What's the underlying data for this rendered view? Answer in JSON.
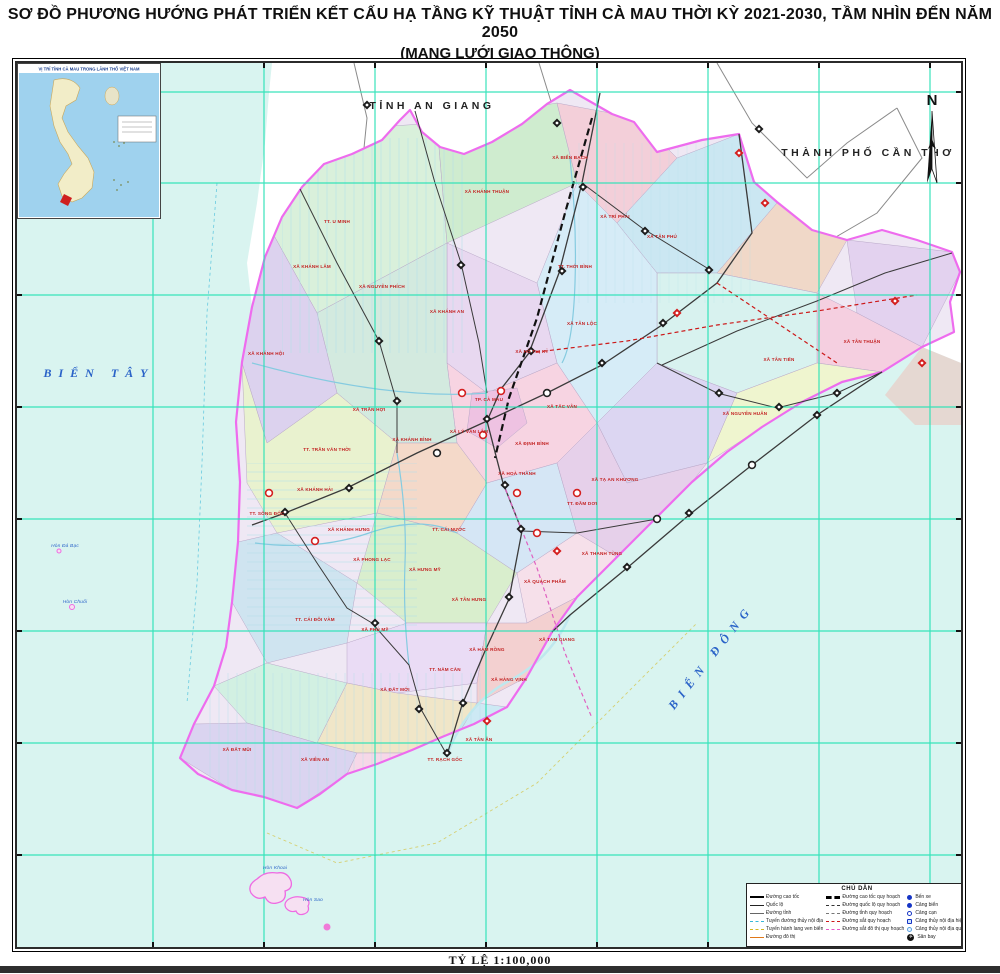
{
  "title": {
    "line1": "SƠ ĐỒ PHƯƠNG HƯỚNG PHÁT TRIỂN KẾT CẤU HẠ TẦNG KỸ THUẬT TỈNH CÀ MAU THỜI KỲ 2021-2030, TẦM NHÌN ĐẾN NĂM 2050",
    "line2": "(MẠNG LƯỚI GIAO THÔNG)"
  },
  "inset": {
    "title": "VỊ TRÍ TỈNH CÀ MAU TRONG LÃNH THỔ VIỆT NAM"
  },
  "compass": {
    "north_label": "N"
  },
  "scale": {
    "label": "TỶ LỆ 1:100,000"
  },
  "legend": {
    "title": "CHÚ DẪN",
    "columns": [
      {
        "items": [
          {
            "type": "exp",
            "label": "Đường cao tốc"
          },
          {
            "type": "nat",
            "label": "Quốc lộ"
          },
          {
            "type": "prov",
            "label": "Đường tỉnh"
          },
          {
            "type": "wat",
            "label": "Tuyến đường thủy nội địa"
          },
          {
            "type": "coast",
            "label": "Tuyến hành lang ven biển"
          },
          {
            "type": "urb",
            "label": "Đường đô thị"
          }
        ]
      },
      {
        "items": [
          {
            "type": "expp",
            "label": "Đường cao tốc quy hoạch"
          },
          {
            "type": "natp",
            "label": "Đường quốc lộ quy hoạch"
          },
          {
            "type": "provp",
            "label": "Đường tỉnh quy hoạch"
          },
          {
            "type": "rail",
            "label": "Đường sắt quy hoạch"
          },
          {
            "type": "metp",
            "label": "Đường sắt đô thị quy hoạch"
          }
        ]
      },
      {
        "items": [
          {
            "type": "port",
            "label": "Bến xe"
          },
          {
            "type": "port2",
            "label": "Cảng biển"
          },
          {
            "type": "open",
            "label": "Cảng cạn"
          },
          {
            "type": "inl",
            "label": "Cảng thủy nội địa hiện hữu"
          },
          {
            "type": "inlp",
            "label": "Cảng thủy nội địa quy hoạch"
          },
          {
            "type": "air",
            "label": "Sân bay"
          }
        ]
      },
      {
        "items": [
          {
            "type": "bridge",
            "label": "Cầu"
          },
          {
            "type": "node",
            "label": "Nút giao quy hoạch"
          },
          {
            "type": "hub",
            "label": "Công trình đầu mối hiện hữu"
          },
          {
            "type": "hubp",
            "label": "Công trình đầu mối quy hoạch"
          },
          {
            "type": "seap",
            "label": "Cảng biển quy hoạch"
          },
          {
            "type": "busp",
            "label": "Bến xe quy hoạch"
          }
        ]
      }
    ]
  },
  "map_labels": [
    {
      "text": "TỈNH AN GIANG",
      "x": 415,
      "y": 46,
      "cls": "region"
    },
    {
      "text": "THÀNH PHỐ CẦN THƠ",
      "x": 851,
      "y": 93,
      "cls": "region"
    },
    {
      "text": "BIỂN TÂY",
      "x": 82,
      "y": 314,
      "cls": "sea"
    },
    {
      "text": "BIỂN ĐÔNG",
      "x": 697,
      "y": 596,
      "cls": "sea",
      "rot": -52
    },
    {
      "text": "TT. U MINH",
      "x": 320,
      "y": 160,
      "cls": "commune"
    },
    {
      "text": "XÃ KHÁNH LÂM",
      "x": 295,
      "y": 205,
      "cls": "commune"
    },
    {
      "text": "XÃ NGUYỄN PHÍCH",
      "x": 365,
      "y": 225,
      "cls": "commune"
    },
    {
      "text": "XÃ KHÁNH AN",
      "x": 430,
      "y": 250,
      "cls": "commune"
    },
    {
      "text": "XÃ KHÁNH HỘI",
      "x": 249,
      "y": 292,
      "cls": "commune"
    },
    {
      "text": "XÃ KHÁNH THUẬN",
      "x": 470,
      "y": 130,
      "cls": "commune"
    },
    {
      "text": "XÃ BIỂN BẠCH",
      "x": 553,
      "y": 96,
      "cls": "commune"
    },
    {
      "text": "XÃ TRÍ PHẢI",
      "x": 598,
      "y": 155,
      "cls": "commune"
    },
    {
      "text": "TT. THỚI BÌNH",
      "x": 558,
      "y": 205,
      "cls": "commune"
    },
    {
      "text": "XÃ TÂN LỘC",
      "x": 565,
      "y": 262,
      "cls": "commune"
    },
    {
      "text": "XÃ HỒ THỊ KỶ",
      "x": 515,
      "y": 290,
      "cls": "commune"
    },
    {
      "text": "XÃ TÂN PHÚ",
      "x": 645,
      "y": 175,
      "cls": "commune"
    },
    {
      "text": "XÃ TÂN TIẾN",
      "x": 762,
      "y": 298,
      "cls": "commune"
    },
    {
      "text": "XÃ NGUYỄN HUÂN",
      "x": 728,
      "y": 352,
      "cls": "commune"
    },
    {
      "text": "XÃ TÂN THUẬN",
      "x": 845,
      "y": 280,
      "cls": "commune"
    },
    {
      "text": "XÃ TẠ AN KHƯƠNG",
      "x": 598,
      "y": 418,
      "cls": "commune"
    },
    {
      "text": "TT. ĐẦM DƠI",
      "x": 565,
      "y": 442,
      "cls": "commune"
    },
    {
      "text": "XÃ THANH TÙNG",
      "x": 585,
      "y": 492,
      "cls": "commune"
    },
    {
      "text": "XÃ QUÁCH PHẨM",
      "x": 528,
      "y": 520,
      "cls": "commune"
    },
    {
      "text": "TP. CÀ MAU",
      "x": 472,
      "y": 338,
      "cls": "commune"
    },
    {
      "text": "XÃ TẮC VÂN",
      "x": 545,
      "y": 345,
      "cls": "commune"
    },
    {
      "text": "XÃ ĐỊNH BÌNH",
      "x": 515,
      "y": 382,
      "cls": "commune"
    },
    {
      "text": "XÃ HOÀ THÀNH",
      "x": 500,
      "y": 412,
      "cls": "commune"
    },
    {
      "text": "XÃ LÝ VĂN LÂM",
      "x": 452,
      "y": 370,
      "cls": "commune"
    },
    {
      "text": "TT. TRẦN VĂN THỜI",
      "x": 310,
      "y": 388,
      "cls": "commune"
    },
    {
      "text": "XÃ TRẦN HỢI",
      "x": 352,
      "y": 348,
      "cls": "commune"
    },
    {
      "text": "XÃ KHÁNH BÌNH",
      "x": 395,
      "y": 378,
      "cls": "commune"
    },
    {
      "text": "TT. SÔNG ĐỐC",
      "x": 250,
      "y": 452,
      "cls": "commune"
    },
    {
      "text": "XÃ KHÁNH HẢI",
      "x": 298,
      "y": 428,
      "cls": "commune"
    },
    {
      "text": "XÃ KHÁNH HƯNG",
      "x": 332,
      "y": 468,
      "cls": "commune"
    },
    {
      "text": "XÃ PHONG LẠC",
      "x": 355,
      "y": 498,
      "cls": "commune"
    },
    {
      "text": "TT. CÁI NƯỚC",
      "x": 432,
      "y": 468,
      "cls": "commune"
    },
    {
      "text": "XÃ HƯNG MỸ",
      "x": 408,
      "y": 508,
      "cls": "commune"
    },
    {
      "text": "XÃ TÂN HƯNG",
      "x": 452,
      "y": 538,
      "cls": "commune"
    },
    {
      "text": "TT. CÁI ĐÔI VÀM",
      "x": 298,
      "y": 558,
      "cls": "commune"
    },
    {
      "text": "XÃ PHÚ MỸ",
      "x": 358,
      "y": 568,
      "cls": "commune"
    },
    {
      "text": "XÃ TAM GIANG",
      "x": 540,
      "y": 578,
      "cls": "commune"
    },
    {
      "text": "TT. NĂM CĂN",
      "x": 428,
      "y": 608,
      "cls": "commune"
    },
    {
      "text": "XÃ HÀM RỒNG",
      "x": 470,
      "y": 588,
      "cls": "commune"
    },
    {
      "text": "XÃ HÀNG VỊNH",
      "x": 492,
      "y": 618,
      "cls": "commune"
    },
    {
      "text": "XÃ ĐẤT MỚI",
      "x": 378,
      "y": 628,
      "cls": "commune"
    },
    {
      "text": "XÃ VIÊN AN",
      "x": 298,
      "y": 698,
      "cls": "commune"
    },
    {
      "text": "TT. RẠCH GỐC",
      "x": 428,
      "y": 698,
      "cls": "commune"
    },
    {
      "text": "XÃ TÂN ÂN",
      "x": 462,
      "y": 678,
      "cls": "commune"
    },
    {
      "text": "XÃ ĐẤT MŨI",
      "x": 220,
      "y": 688,
      "cls": "commune"
    },
    {
      "text": "Hòn Đá Bạc",
      "x": 48,
      "y": 484,
      "cls": "island"
    },
    {
      "text": "Hòn Chuối",
      "x": 58,
      "y": 540,
      "cls": "island"
    },
    {
      "text": "Hòn Khoai",
      "x": 258,
      "y": 806,
      "cls": "island"
    },
    {
      "text": "Hòn Sao",
      "x": 296,
      "y": 838,
      "cls": "island"
    }
  ]
}
